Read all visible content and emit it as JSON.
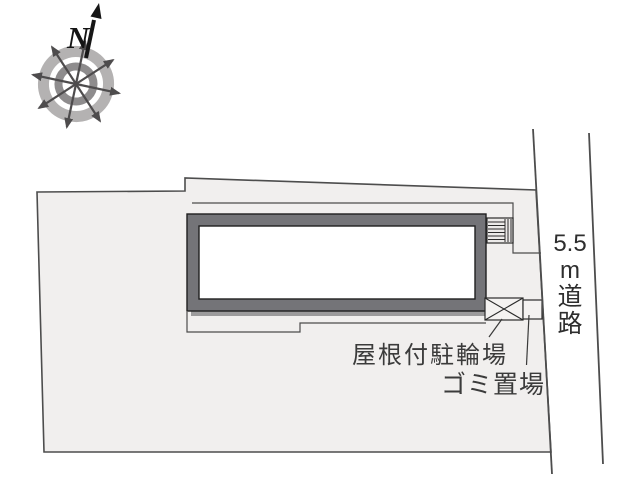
{
  "page": {
    "background": "#ffffff",
    "type": "site-plan"
  },
  "compass": {
    "north_label": "N",
    "ring_outer_color": "#b4b2b2",
    "ring_inner_color": "#8e8c8d",
    "spoke_color": "#4e4c4d",
    "north_arrow_color": "#161616"
  },
  "site": {
    "fill": "#f1efee",
    "boundary_color": "#4d4d4d"
  },
  "building": {
    "fill": "#747478",
    "interior": "#ffffff",
    "outline": "#1f1f1f"
  },
  "road": {
    "width_value": "5.5",
    "unit": "m",
    "name": "道路",
    "full_label": "5.5m道路",
    "edge_color": "#4d4d4d"
  },
  "labels": {
    "bike_parking": "屋根付駐輪場",
    "garbage": "ゴミ置場",
    "text_color": "#3b3b3b"
  }
}
